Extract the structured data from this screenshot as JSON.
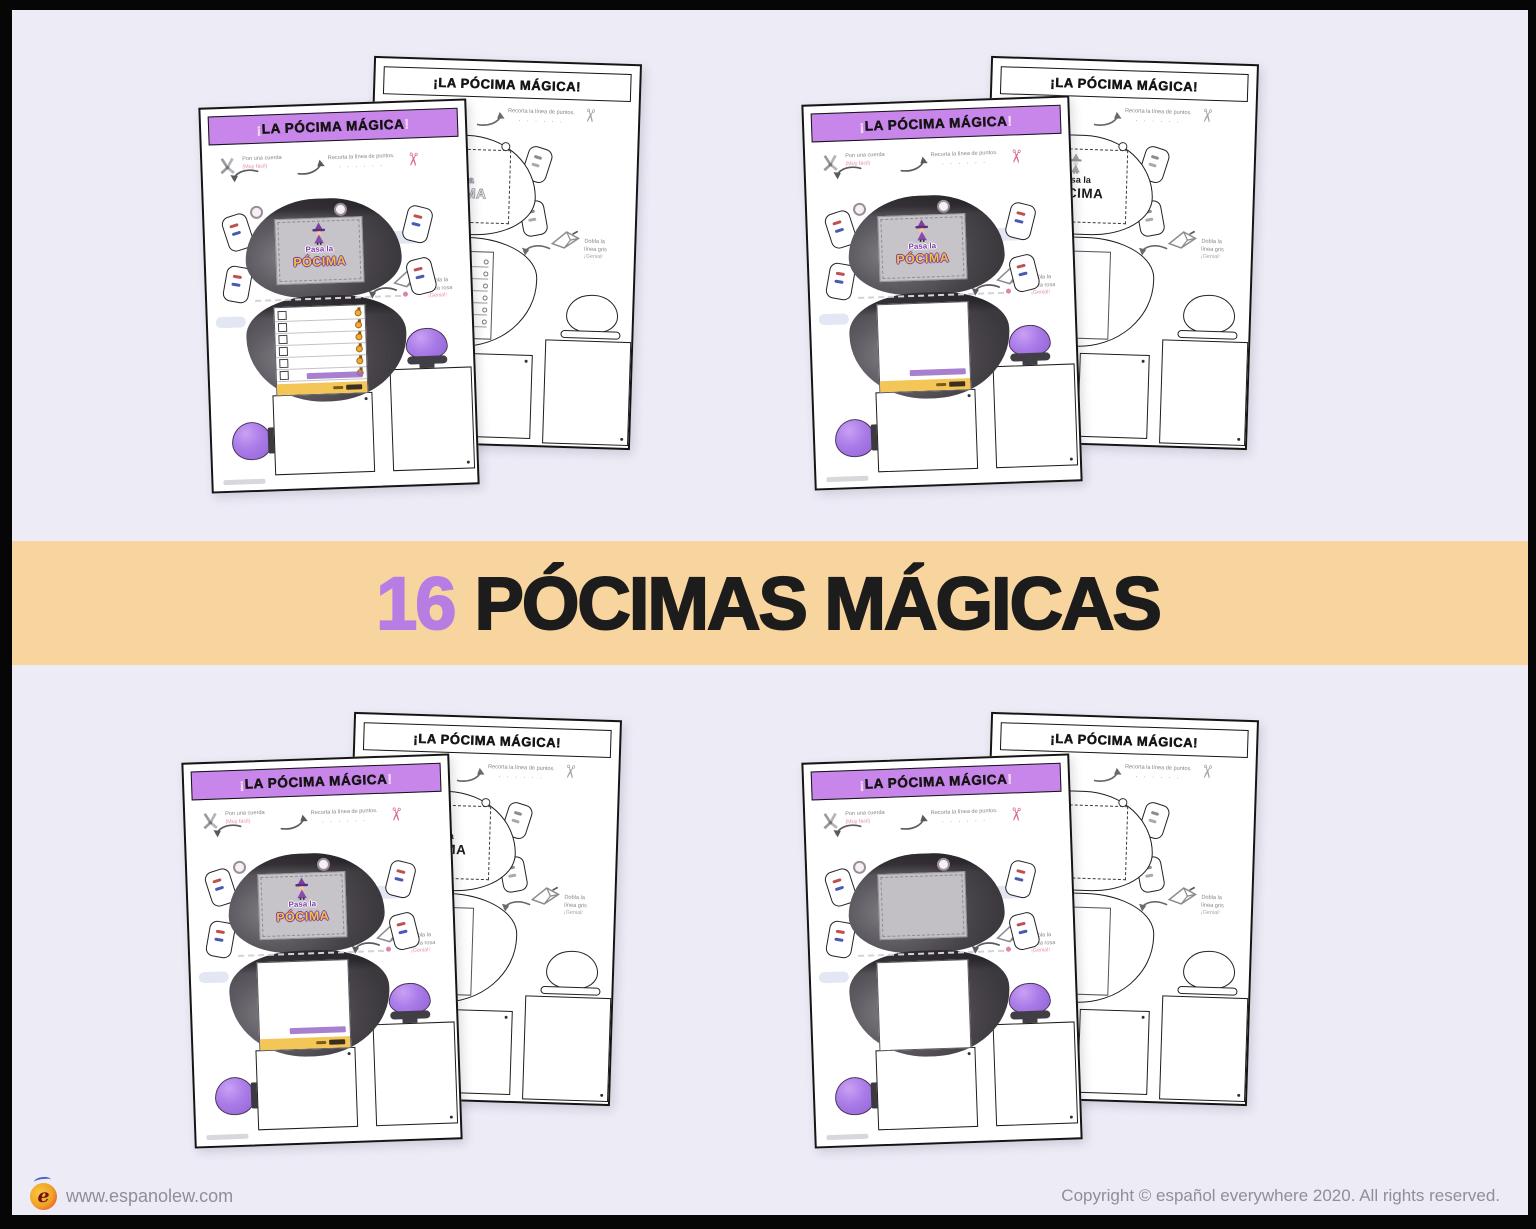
{
  "banner": {
    "count": "16",
    "title": "PÓCIMAS MÁGICAS",
    "count_color": "#b87de2",
    "background": "#f8d59e"
  },
  "footer": {
    "logo_letter": "e",
    "website": "www.espanolew.com",
    "copyright": "Copyright © español everywhere 2020. All rights reserved."
  },
  "worksheet": {
    "title_open": "¡",
    "title_core": "LA PÓCIMA MÁGICA",
    "title_close": "!",
    "back_title": "¡LA PÓCIMA MÁGICA!",
    "ann_string": "Pon una cuerda",
    "ann_string_sub": "(Muy fácil)",
    "ann_cut": "Recorta la línea de puntos.",
    "ann_cut_dots": "· · · · · ·",
    "ann_fold_1": "Dobla la",
    "ann_fold_2": "línea rosa",
    "ann_fold_back_2": "línea gris",
    "ann_fold_3": "¡Genial!",
    "label_line1": "Pasa la",
    "label_line2": "PÓCIMA",
    "header_band_color": "#c886ea",
    "cauldron_color": "#47434a",
    "potion_color": "#aa7ce8",
    "strip_color": "#f4c658"
  },
  "pairs": [
    {
      "position": "top-left",
      "front": "checklist",
      "back": "ghost"
    },
    {
      "position": "top-right",
      "front": "blank",
      "back": "label"
    },
    {
      "position": "bottom-left",
      "front": "blank",
      "back": "label"
    },
    {
      "position": "bottom-right",
      "front": "plain",
      "back": "plain"
    }
  ]
}
